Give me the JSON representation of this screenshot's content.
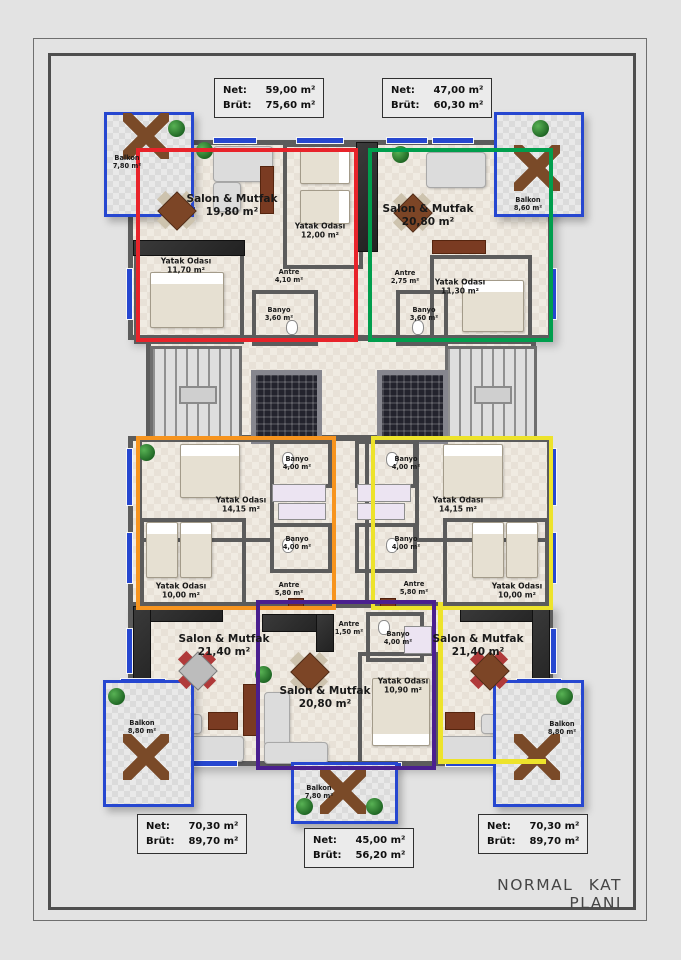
{
  "title": "NORMAL KAT PLANI",
  "colors": {
    "apt-red": "#e8232a",
    "apt-green": "#009e4d",
    "apt-orange": "#f7941e",
    "apt-yellow": "#ede32b",
    "apt-purple": "#4a1f8f",
    "balcony-blue": "#2647d0",
    "wall": "#5c5c5c"
  },
  "area_boxes": [
    {
      "id": "top-left",
      "net_label": "Net:",
      "net": "59,00 m²",
      "brut_label": "Brüt:",
      "brut": "75,60 m²"
    },
    {
      "id": "top-right",
      "net_label": "Net:",
      "net": "47,00 m²",
      "brut_label": "Brüt:",
      "brut": "60,30 m²"
    },
    {
      "id": "bottom-left",
      "net_label": "Net:",
      "net": "70,30 m²",
      "brut_label": "Brüt:",
      "brut": "89,70 m²"
    },
    {
      "id": "bottom-middle",
      "net_label": "Net:",
      "net": "45,00 m²",
      "brut_label": "Brüt:",
      "brut": "56,20 m²"
    },
    {
      "id": "bottom-right",
      "net_label": "Net:",
      "net": "70,30 m²",
      "brut_label": "Brüt:",
      "brut": "89,70 m²"
    }
  ],
  "rooms": [
    {
      "name": "Balkon",
      "area": "7,80 m²"
    },
    {
      "name": "Salon & Mutfak",
      "area": "19,80 m²"
    },
    {
      "name": "Yatak Odası",
      "area": "12,00 m²"
    },
    {
      "name": "Yatak Odası",
      "area": "11,70 m²"
    },
    {
      "name": "Antre",
      "area": "4,10 m²"
    },
    {
      "name": "Banyo",
      "area": "3,60 m²"
    },
    {
      "name": "Balkon",
      "area": "8,60 m²"
    },
    {
      "name": "Salon & Mutfak",
      "area": "20,80 m²"
    },
    {
      "name": "Yatak Odası",
      "area": "11,30 m²"
    },
    {
      "name": "Antre",
      "area": "2,75 m²"
    },
    {
      "name": "Banyo",
      "area": "3,60 m²"
    },
    {
      "name": "Yatak Odası",
      "area": "14,15 m²"
    },
    {
      "name": "Banyo",
      "area": "4,00 m²"
    },
    {
      "name": "Banyo",
      "area": "4,00 m²"
    },
    {
      "name": "Yatak Odası",
      "area": "10,00 m²"
    },
    {
      "name": "Antre",
      "area": "5,80 m²"
    },
    {
      "name": "Banyo",
      "area": "4,00 m²"
    },
    {
      "name": "Banyo",
      "area": "4,00 m²"
    },
    {
      "name": "Yatak Odası",
      "area": "14,15 m²"
    },
    {
      "name": "Yatak Odası",
      "area": "10,00 m²"
    },
    {
      "name": "Antre",
      "area": "5,80 m²"
    },
    {
      "name": "Salon & Mutfak",
      "area": "21,40 m²"
    },
    {
      "name": "Balkon",
      "area": "8,80 m²"
    },
    {
      "name": "Antre",
      "area": "1,50 m²"
    },
    {
      "name": "Banyo",
      "area": "4,00 m²"
    },
    {
      "name": "Yatak Odası",
      "area": "10,90 m²"
    },
    {
      "name": "Salon & Mutfak",
      "area": "20,80 m²"
    },
    {
      "name": "Balkon",
      "area": "7,80 m²"
    },
    {
      "name": "Salon & Mutfak",
      "area": "21,40 m²"
    },
    {
      "name": "Balkon",
      "area": "8,80 m²"
    }
  ]
}
